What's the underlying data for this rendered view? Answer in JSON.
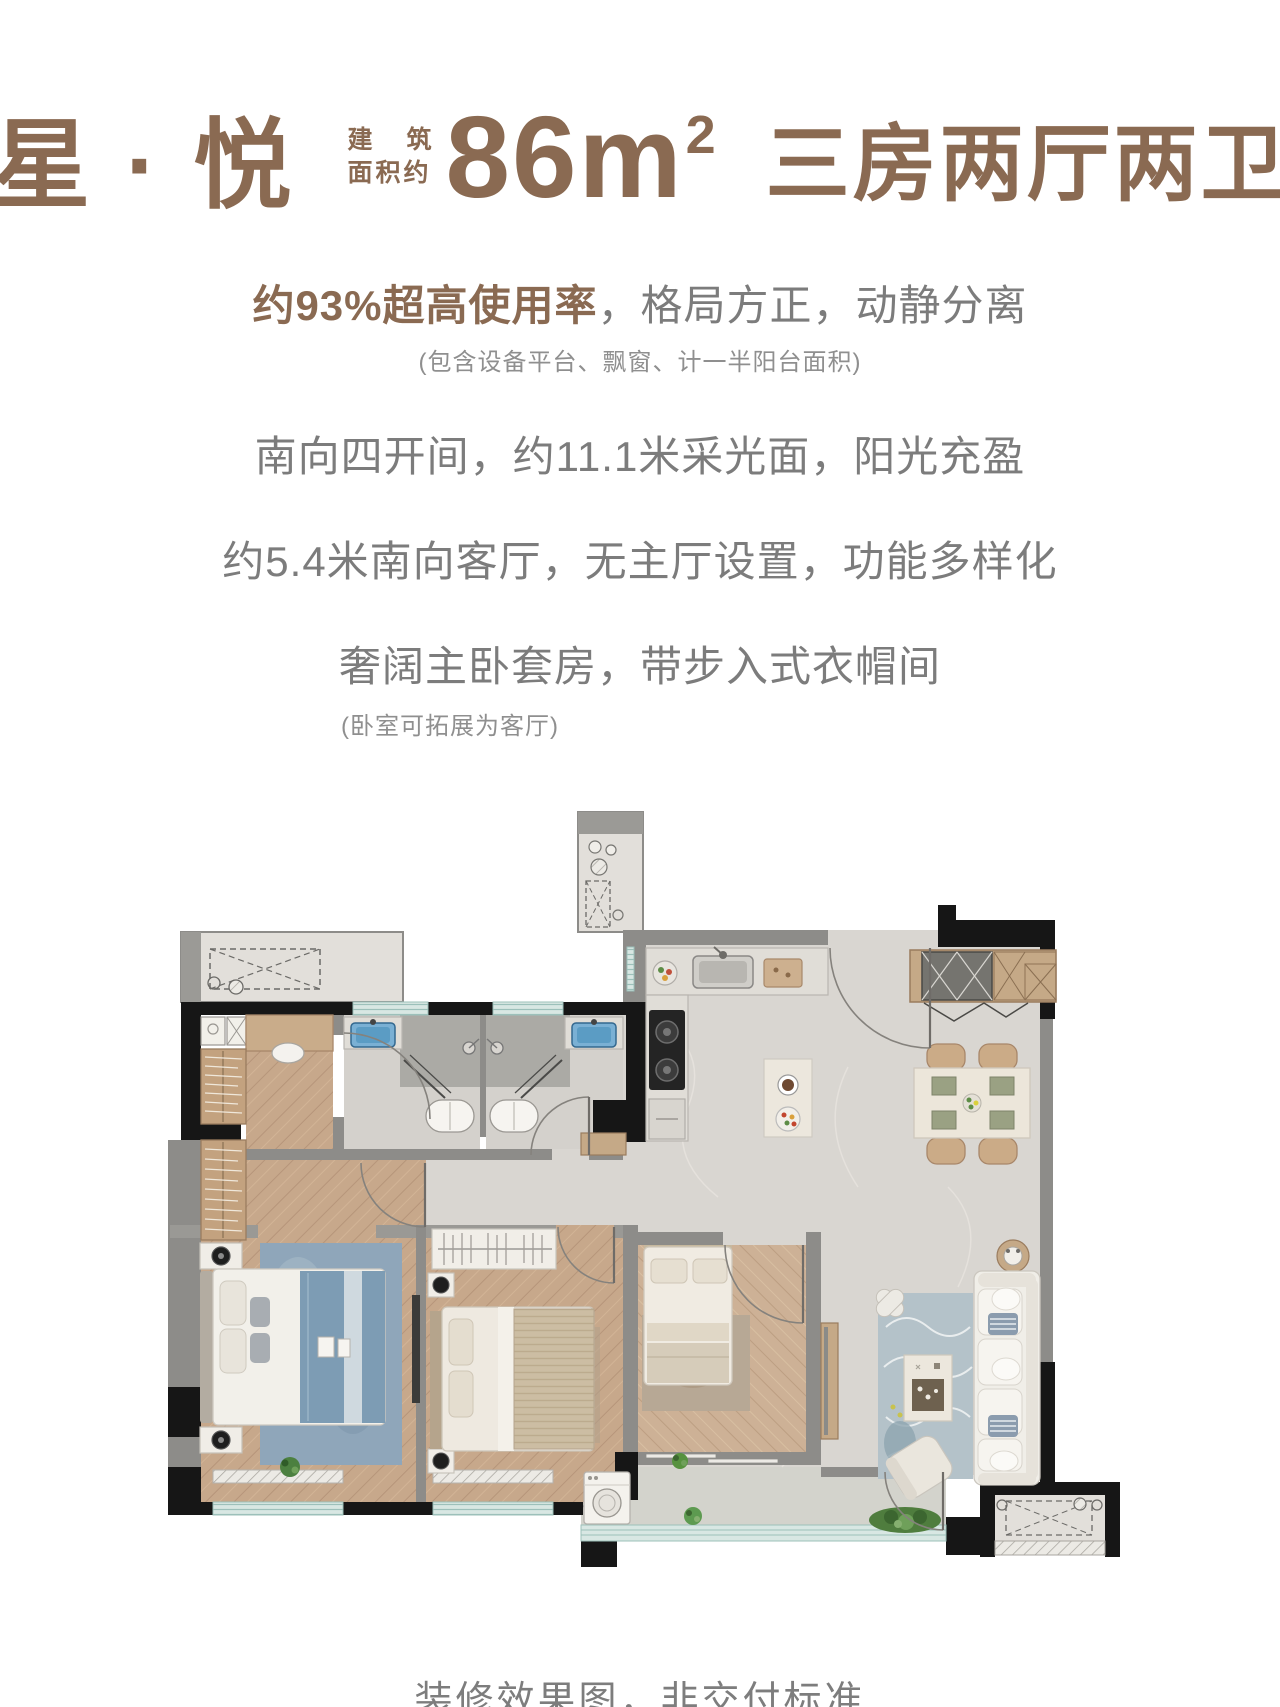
{
  "header": {
    "title": "星 · 悦",
    "area_label_line1": "建筑",
    "area_label_line2": "面积约",
    "area_value": "86m",
    "area_exponent": "2",
    "layout": "三房两厅两卫"
  },
  "features": {
    "line1_highlight": "约93%超高使用率",
    "line1_rest": "，格局方正，动静分离",
    "line1_note": "(包含设备平台、飘窗、计一半阳台面积)",
    "line2": "南向四开间，约11.1米采光面，阳光充盈",
    "line3": "约5.4米南向客厅，无主厅设置，功能多样化",
    "line4": "奢阔主卧套房，带步入式衣帽间",
    "line4_note": "(卧室可拓展为客厅)"
  },
  "footer": {
    "disclaimer": "装修效果图，非交付标准"
  },
  "colors": {
    "brand_brown": "#8a6a52",
    "text_gray": "#7c7c7c",
    "note_gray": "#8f8f8f",
    "plan_wood": "#c7a88b",
    "plan_tile": "#d9d6d1",
    "plan_wall_dark": "#161616",
    "plan_wall_gray": "#8d8c89",
    "plan_sink_blue": "#7ab0d4",
    "plan_rug_blue": "#8fa6ba"
  }
}
